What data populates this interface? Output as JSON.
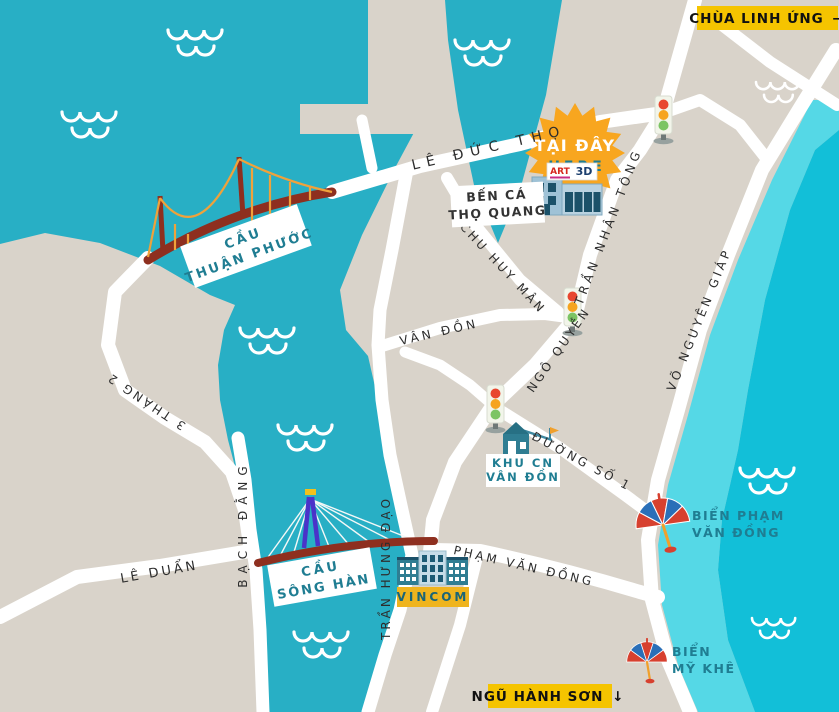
{
  "map_title": "Da Nang tourist map",
  "colors": {
    "land": "#D9D3CA",
    "river": "#28AFC5",
    "ocean": "#12BFD8",
    "beach": "#55D8E6",
    "road": "#FFFFFF",
    "badge_yellow": "#F5C400",
    "vincom_yellow": "#EFB41E",
    "marker_orange": "#F8A61F",
    "bridge_red": "#8E2F1F",
    "cable_orange": "#EFA23B",
    "pylon_purple": "#4A33C9",
    "label_teal": "#1F7D92",
    "street_text": "#2D2D2D",
    "building_teal": "#2F7D92"
  },
  "badges": {
    "chua_linh_ung": {
      "label": "CHÙA LINH ỨNG",
      "arrow": "→"
    },
    "ngu_hanh_son": {
      "label": "NGŨ HÀNH SƠN",
      "arrow": "↓"
    }
  },
  "marker": {
    "line1": "TẠI ĐÂY",
    "line2": "HERE"
  },
  "museum_sign": {
    "art": "ART",
    "threed": "3D"
  },
  "streets": {
    "le_duc_tho": "LÊ ĐỨC THỌ",
    "chu_huy_man": "CHU HUY MÂN",
    "tran_nhan_tong": "TRẦN NHÂN TÔNG",
    "van_don": "VÂN ĐỒN",
    "ngo_quyen": "NGÔ QUYỀN",
    "vo_nguyen_giap": "VÕ NGUYÊN GIÁP",
    "duong_so_1": "ĐƯỜNG SỐ 1",
    "ba_thang_hai": "3 THÁNG 2",
    "bach_dang": "BẠCH ĐẰNG",
    "le_duan": "LÊ DUẨN",
    "tran_hung_dao": "TRẦN HƯNG ĐẠO",
    "pham_van_dong": "PHẠM VĂN ĐỒNG"
  },
  "places": {
    "cau_thuan_phuoc": {
      "line1": "CẦU",
      "line2": "THUẬN PHƯỚC"
    },
    "cau_song_han": {
      "line1": "CẦU",
      "line2": "SÔNG HÀN"
    },
    "ben_ca": {
      "line1": "BẾN CÁ",
      "line2": "THỌ QUANG"
    },
    "khu_cn": {
      "line1": "KHU CN",
      "line2": "VÂN ĐỒN"
    },
    "bien_pham_van_dong": {
      "line1": "BIỂN PHẠM",
      "line2": "VĂN ĐỒNG"
    },
    "bien_my_khe": {
      "line1": "BIỂN",
      "line2": "MỸ KHÊ"
    },
    "vincom": "VINCOM"
  }
}
